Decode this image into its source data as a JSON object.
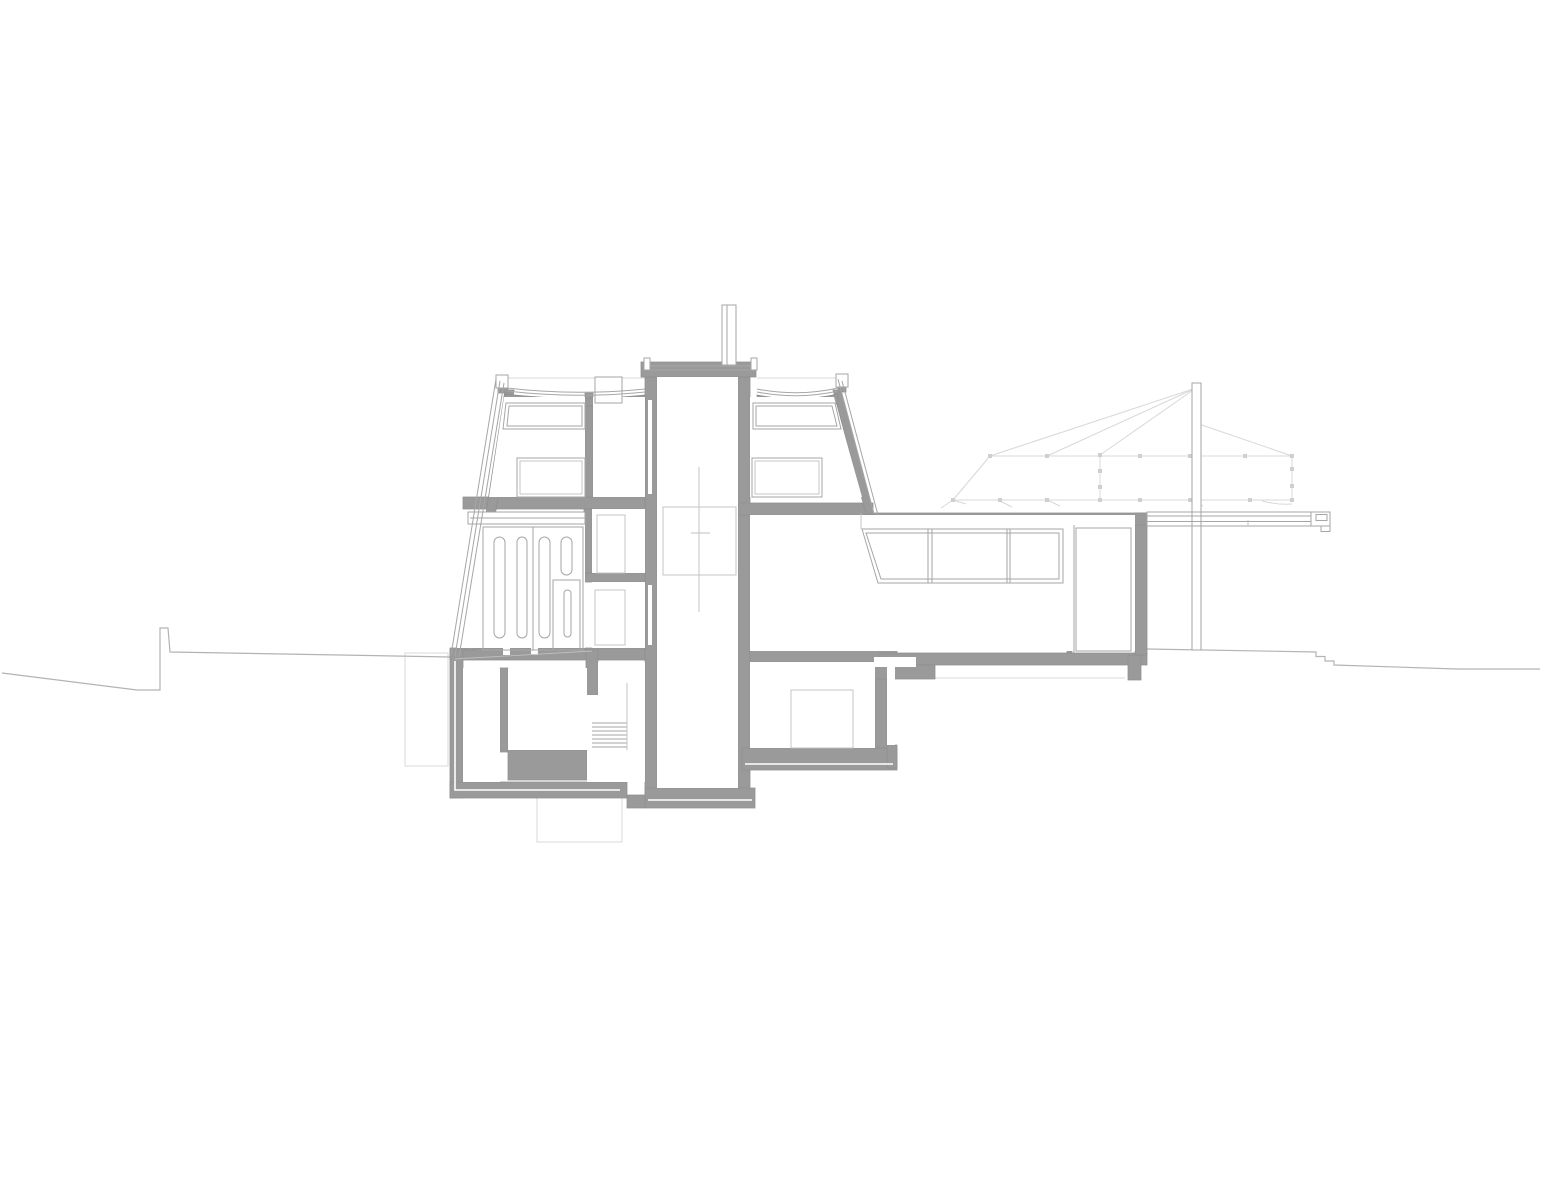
{
  "page": {
    "title": "Architectural cross-section drawing",
    "background": "#ffffff"
  },
  "drawing": {
    "type": "building-section",
    "description": "Black-and-white architect's cross-section: multi-storey house with central elevator shaft and chimney, mansard-profile upper floor with clerestory windows, ground floor with louvered panels, basement rooms with stair, single-storey glazed wing to the right ending in a cantilevered canopy beam, a mast with faint tensile cable canopy, and terrain lines stepping down left and right.",
    "colors": {
      "background": "#ffffff",
      "wall_fill": "#9a9a9a",
      "wall_edge": "#8f8f8f",
      "detail_line": "#a6a6a6",
      "light_line": "#bfbfbf",
      "faint_line": "#d8d8d8",
      "terrain_line": "#b3b3b3",
      "node_fill": "#cfcfcf",
      "room_fill": "#ffffff",
      "lining": "#ffffff"
    },
    "elements": {
      "terrain_left": "stepped ground line, left side",
      "terrain_right": "stepped ground line, right side",
      "excavation_outlines": "faint below-grade excavation outlines",
      "tensile_canopy": "faint mast-and-cable tent canopy",
      "mast": "canopy mast",
      "canopy_beam": "cantilevered roof beam",
      "chimney": "chimney / vent stack",
      "elevator_shaft": "central elevator shaft",
      "elevator_cab": "elevator cab outline",
      "skylight": "rooftop skylight box",
      "upper_floor_left_room": "upper floor room, left",
      "upper_floor_right_room": "upper floor room, right",
      "louver_panels": "ground floor louvered wall panels",
      "stair": "basement stair",
      "basement_rooms": "basement rooms",
      "cellar_room": "cellar under right bay",
      "glazed_wing": "single-storey glazed wing",
      "clerestory_windows": "clerestory window bands"
    }
  }
}
